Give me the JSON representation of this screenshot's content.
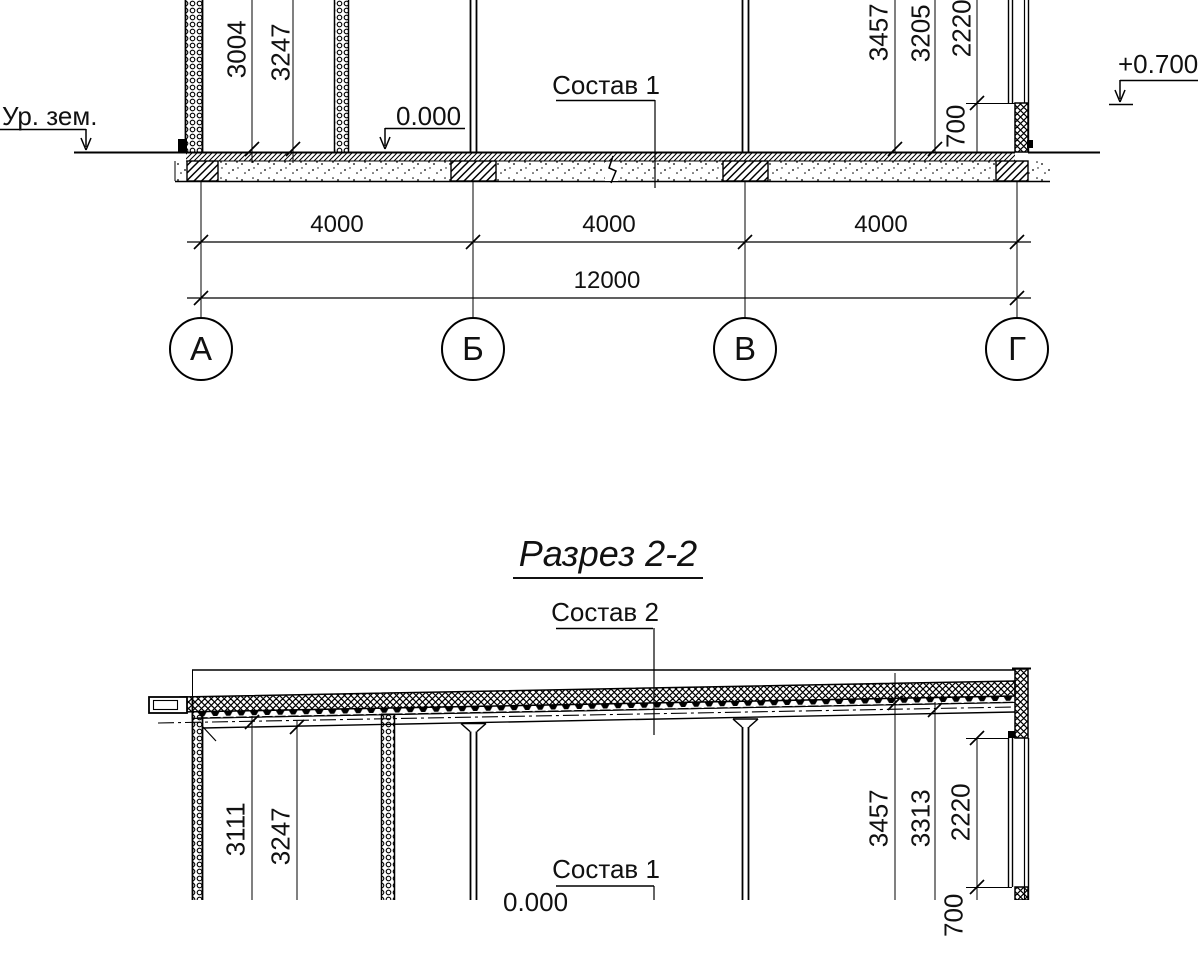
{
  "section1": {
    "ground_label": "Ур. зем.",
    "level_zero": "0.000",
    "level_plus": "+0.700",
    "composition_floor": "Состав 1",
    "dims_left": [
      "3004",
      "3247"
    ],
    "dims_right": [
      "3457",
      "3205",
      "2220",
      "700"
    ]
  },
  "grid": {
    "spans": [
      "4000",
      "4000",
      "4000"
    ],
    "total": "12000",
    "axes": [
      "А",
      "Б",
      "В",
      "Г"
    ]
  },
  "section2": {
    "title": "Разрез 2-2",
    "composition_roof": "Состав 2",
    "composition_floor": "Состав 1",
    "level_zero": "0.000",
    "dims_left": [
      "3111",
      "3247"
    ],
    "dims_right": [
      "3457",
      "3313",
      "2220",
      "700"
    ]
  }
}
